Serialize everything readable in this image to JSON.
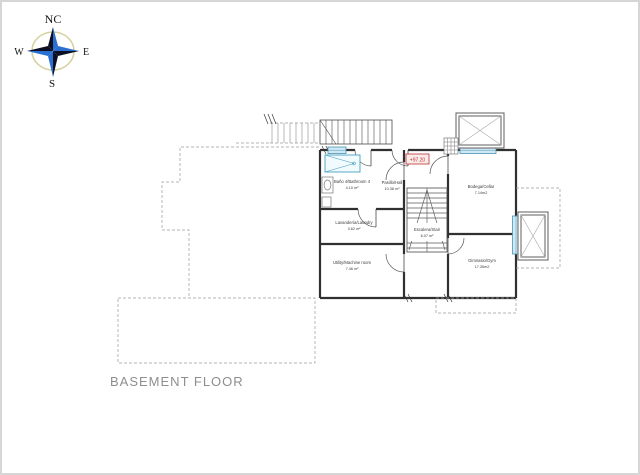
{
  "page": {
    "title": "BASEMENT FLOOR"
  },
  "compass": {
    "north": "NC",
    "east": "E",
    "south": "S",
    "west": "W"
  },
  "plan": {
    "elevation_badge": "+97.20",
    "rooms": {
      "bathroom": {
        "name": "Baño 4/Bathroom 4",
        "area": "4.10 m²"
      },
      "hall": {
        "name": "Pasillo/Hall",
        "area": "10.38 m²"
      },
      "laundry": {
        "name": "Lavandería/Laundry",
        "area": "3.62 m²"
      },
      "utility": {
        "name": "Utility/Machine room",
        "area": "7.46 m²"
      },
      "stair": {
        "name": "Escalera/Stair",
        "area": "6.07 m²"
      },
      "cellar": {
        "name": "Bodega/Cellar",
        "area": "7.14m2"
      },
      "gym": {
        "name": "Gimnasio/Gym",
        "area": "17.35m2"
      }
    },
    "colors": {
      "wall": "#303030",
      "window_fill": "#cfe9f4",
      "window_stroke": "#4a93b4",
      "dashed_outline": "#8f8f8f",
      "accent_red": "#c03030",
      "fixture_blue": "#49a0c0",
      "compass_dark": "#0c1022",
      "compass_blue": "#2a6fd2",
      "compass_ring": "#d6d2a0"
    }
  }
}
